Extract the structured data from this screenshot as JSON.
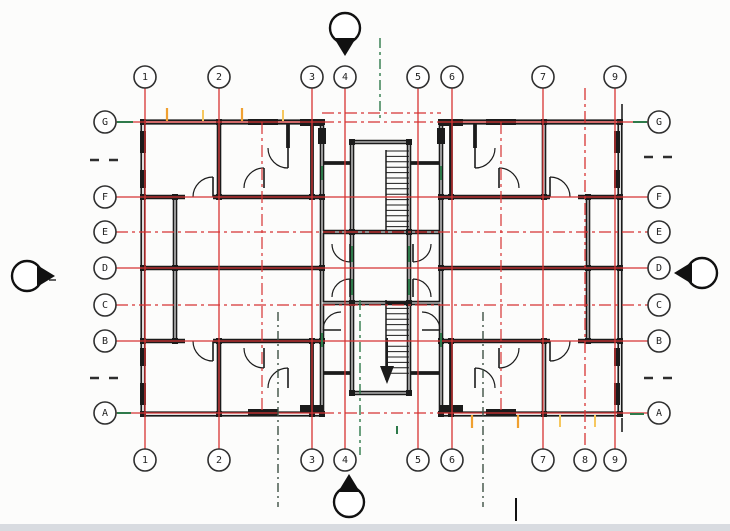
{
  "app": {
    "type": "architectural-floor-plan",
    "description": "Typical residential floor plan, symmetric wings with central stair core"
  },
  "colors": {
    "background": "#fcfcfb",
    "wall_black": "#1b1b1b",
    "grid_red": "#d63333",
    "centerline_green": "#2e7a4a",
    "aux_dash_dark": "#3d5044",
    "tick_orange": "#f0a030",
    "tick_orange_light": "#f6c75e",
    "bubble_stroke": "#2f2f2f",
    "bubble_fill": "#ffffff",
    "label_color": "#222222",
    "marker_black": "#111111",
    "footer_gray": "#d8dbe0",
    "side_dash_gray": "#2e2e2e"
  },
  "grid": {
    "bubble_radius": 11,
    "top_bubble_y": 77,
    "bottom_bubble_y": 460,
    "left_bubble_x": 105,
    "right_bubble_x": 659,
    "columns": [
      {
        "label": "1",
        "x": 145,
        "top": true,
        "bottom": true,
        "dash": false
      },
      {
        "label": "2",
        "x": 219,
        "top": true,
        "bottom": true,
        "dash": false
      },
      {
        "label": "3",
        "x": 312,
        "top": true,
        "bottom": true,
        "dash": false
      },
      {
        "label": "4",
        "x": 345,
        "top": true,
        "bottom": true,
        "dash": false
      },
      {
        "label": "5",
        "x": 418,
        "top": true,
        "bottom": true,
        "dash": false
      },
      {
        "label": "6",
        "x": 452,
        "top": true,
        "bottom": true,
        "dash": false
      },
      {
        "label": "7",
        "x": 543,
        "top": true,
        "bottom": true,
        "dash": false
      },
      {
        "label": "8",
        "x": 585,
        "top": false,
        "bottom": true,
        "dash": true
      },
      {
        "label": "9",
        "x": 615,
        "top": true,
        "bottom": true,
        "dash": false
      }
    ],
    "rows": [
      {
        "label": "G",
        "y": 122,
        "dash": false
      },
      {
        "label": "F",
        "y": 197,
        "dash": false
      },
      {
        "label": "E",
        "y": 232,
        "dash": true
      },
      {
        "label": "D",
        "y": 268,
        "dash": false
      },
      {
        "label": "C",
        "y": 305,
        "dash": true
      },
      {
        "label": "B",
        "y": 341,
        "dash": false
      },
      {
        "label": "A",
        "y": 413,
        "dash": false
      }
    ]
  },
  "markers": {
    "radius": 15,
    "items": [
      {
        "name": "top",
        "dir": "down",
        "cx": 345,
        "cy": 28
      },
      {
        "name": "bottom",
        "dir": "up",
        "cx": 349,
        "cy": 502
      },
      {
        "name": "left",
        "dir": "right",
        "cx": 27,
        "cy": 276
      },
      {
        "name": "right",
        "dir": "left",
        "cx": 702,
        "cy": 273
      }
    ]
  }
}
